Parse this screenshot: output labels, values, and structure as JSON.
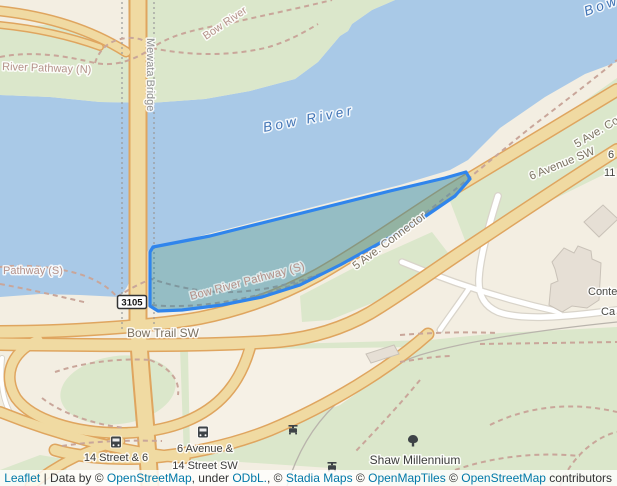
{
  "map": {
    "labels": {
      "river": "Bow River",
      "river_fragment": "Bow R",
      "pathway_n": "River Pathway (N)",
      "pathway_n_2": "Bow River",
      "mewata_bridge": "Mewata Bridge",
      "five_ave_connector": "5 Ave. Connector",
      "six_avenue_sw": "6 Avenue SW",
      "fragment_6": "6",
      "fragment_11": "11",
      "bow_trail_sw": "Bow Trail SW",
      "route_shield": "3105",
      "pathway_s_partial": "Pathway (S)",
      "pathway_s": "Bow River Pathway (S)",
      "stop_14_street": "14 Street & 6",
      "stop_6_avenue_line1": "6 Avenue &",
      "stop_6_avenue_line2": "14 Street SW",
      "shaw_millennium": "Shaw Millennium",
      "fragment_conte": "Conte",
      "fragment_ca": "Ca"
    },
    "colors": {
      "water": "#a9c9e7",
      "park_green": "#dbe7cb",
      "land_beige": "#f3eee2",
      "road_fill": "#f0daa2",
      "road_casing": "#dfa55f",
      "minor_road": "#ffffff",
      "pathway_dash": "#c9a69a",
      "selection_stroke": "#3085ec",
      "selection_fill": "rgba(47,136,164,0.48)",
      "river_label": "#3f72b4",
      "street_label": "#7c7262",
      "pathway_label": "#b5928a",
      "poi_label": "#3d3d3d",
      "link_blue": "#0078a8"
    }
  },
  "attribution": {
    "leaflet": "Leaflet",
    "divider": "|",
    "data_by": "Data by ©",
    "osm": "OpenStreetMap",
    "under": ", under",
    "odbl": "ODbL.",
    "sep2": ", ©",
    "stadia": "Stadia Maps",
    "sep3": "©",
    "openmaptiles": "OpenMapTiles",
    "sep4": "©",
    "osm2": "OpenStreetMap",
    "contributors": "contributors"
  }
}
